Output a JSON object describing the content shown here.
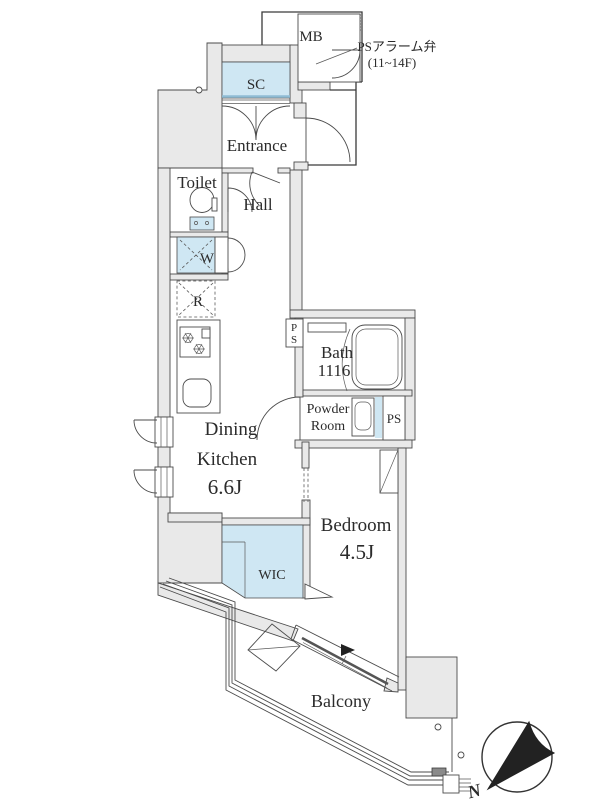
{
  "floor_plan": {
    "rooms": {
      "meter_box": {
        "label": "MB"
      },
      "shoe_closet": {
        "label": "SC"
      },
      "entrance": {
        "label": "Entrance"
      },
      "toilet": {
        "label": "Toilet"
      },
      "hall": {
        "label": "Hall"
      },
      "washer": {
        "label": "W"
      },
      "refrigerator": {
        "label": "R"
      },
      "pipe_space_upper": {
        "char1": "P",
        "char2": "S"
      },
      "bath": {
        "label": "Bath",
        "size": "1116"
      },
      "powder_room": {
        "label_line1": "Powder",
        "label_line2": "Room"
      },
      "pipe_space_right": {
        "label": "PS"
      },
      "dining_kitchen": {
        "label_line1": "Dining",
        "label_line2": "Kitchen",
        "size": "6.6J"
      },
      "bedroom": {
        "label": "Bedroom",
        "size": "4.5J"
      },
      "walk_in_closet": {
        "label": "WIC"
      },
      "balcony": {
        "label": "Balcony"
      }
    },
    "annotations": {
      "ps_alarm_valve": {
        "line1": "PSアラーム弁",
        "line2": "(11~14F)"
      }
    },
    "compass": {
      "north_label": "N"
    },
    "colors": {
      "wall_fill": "#e9e9e9",
      "accent_blue": "#cfe7f3",
      "line_dark": "#4b4b4b"
    }
  }
}
